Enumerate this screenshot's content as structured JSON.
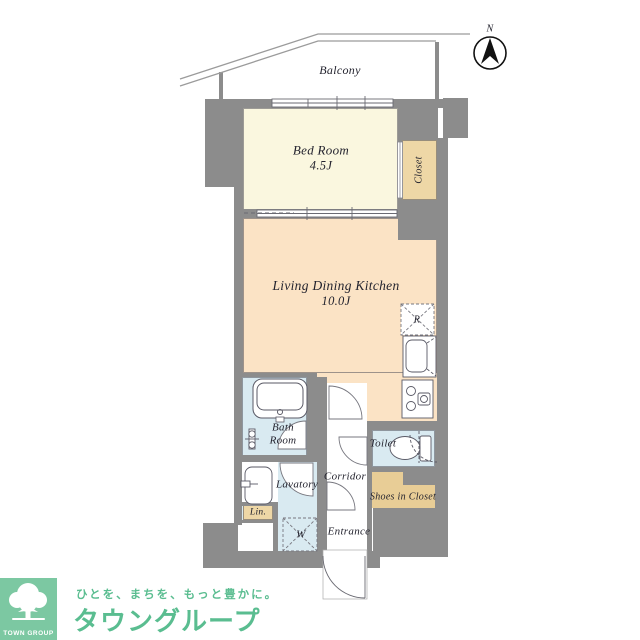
{
  "compass": {
    "label": "N"
  },
  "balcony": {
    "label": "Balcony"
  },
  "rooms": {
    "bedroom": {
      "name": "Bed Room",
      "size": "4.5J"
    },
    "closet": {
      "label": "Closet"
    },
    "ldk": {
      "name": "Living Dining Kitchen",
      "size": "10.0J"
    },
    "refrigerator": {
      "label": "R"
    },
    "bath": {
      "label": "Bath Room"
    },
    "lavatory": {
      "label": "Lavatory"
    },
    "linen": {
      "label": "Lin."
    },
    "washer": {
      "label": "W"
    },
    "corridor": {
      "label": "Corridor"
    },
    "entrance": {
      "label": "Entrance"
    },
    "toilet": {
      "label": "Toilet"
    },
    "shoes": {
      "label": "Shoes in Closet"
    }
  },
  "branding": {
    "logo_text": "TOWN GROUP",
    "tagline": "ひとを、まちを、もっと豊かに。",
    "company": "タウングループ"
  },
  "palette": {
    "wall": "#8c8c8c",
    "cream": "#faf7df",
    "peach": "#fbe3c5",
    "tan": "#eed7a6",
    "tan2": "#e8cd96",
    "blue": "#d9eaf1",
    "ink": "#23232e",
    "line": "#5a5a66",
    "green": "#7cc8a2",
    "green-text": "#5abd90"
  }
}
